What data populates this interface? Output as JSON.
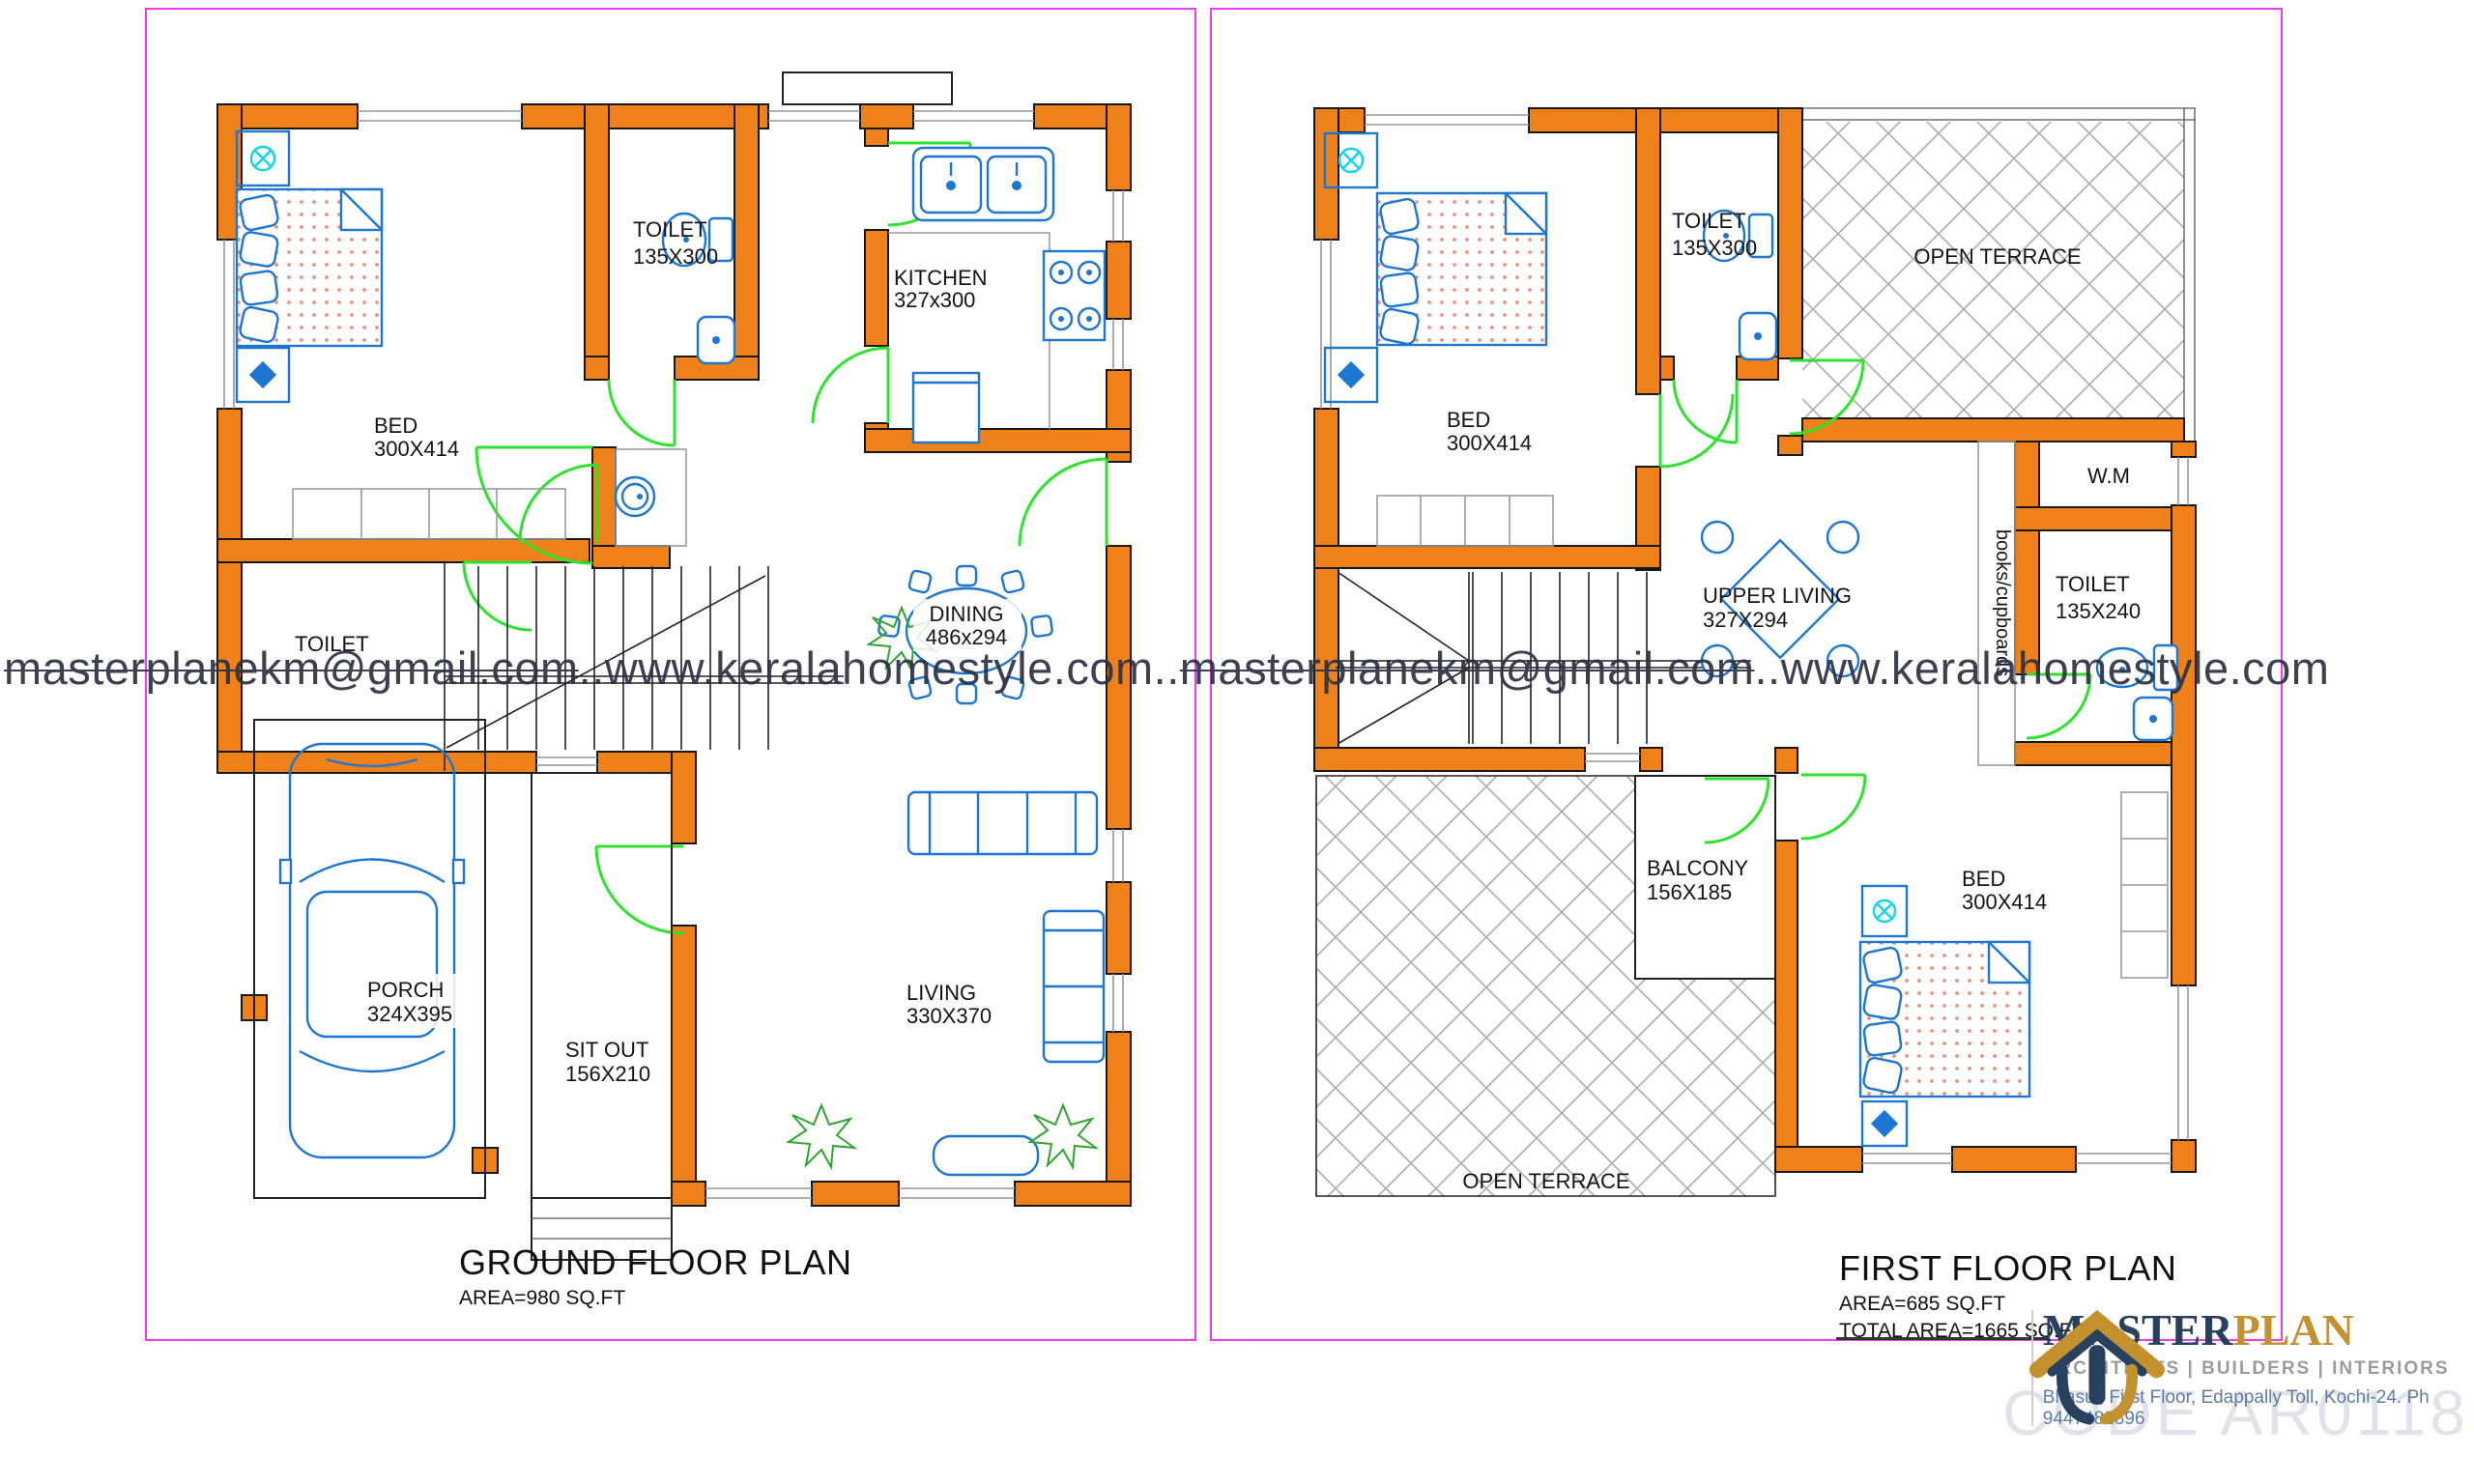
{
  "watermark": {
    "email": "masterplanekm@gmail.com",
    "sep": "..",
    "site": "www.keralahomestyle.com"
  },
  "ground_floor": {
    "title": "GROUND FLOOR PLAN",
    "area_label": "AREA=980 SQ.FT",
    "rooms": {
      "bed": {
        "name": "BED",
        "dims": "300X414"
      },
      "toilet_top": {
        "name": "TOILET",
        "dims": "135X300"
      },
      "kitchen": {
        "name": "KITCHEN",
        "dims": "327x300"
      },
      "dining": {
        "name": "DINING",
        "dims": "486x294"
      },
      "toilet_small": {
        "name": "TOILET"
      },
      "porch": {
        "name": "PORCH",
        "dims": "324X395"
      },
      "sitout": {
        "name": "SIT OUT",
        "dims": "156X210"
      },
      "living": {
        "name": "LIVING",
        "dims": "330X370"
      }
    }
  },
  "first_floor": {
    "title": "FIRST FLOOR PLAN",
    "area_label": "AREA=685 SQ.FT",
    "total_area_label": "TOTAL AREA=1665 SQ.FT",
    "rooms": {
      "bed_top": {
        "name": "BED",
        "dims": "300X414"
      },
      "toilet_top": {
        "name": "TOILET",
        "dims": "135X300"
      },
      "open_terrace_top": {
        "name": "OPEN TERRACE"
      },
      "wm": {
        "name": "W.M"
      },
      "toilet_right": {
        "name": "TOILET",
        "dims": "135X240"
      },
      "upper_living": {
        "name": "UPPER LIVING",
        "dims": "327X294"
      },
      "books": {
        "name": "books/cupboards"
      },
      "balcony": {
        "name": "BALCONY",
        "dims": "156X185"
      },
      "open_terrace_bottom": {
        "name": "OPEN TERRACE"
      },
      "bed_bottom": {
        "name": "BED",
        "dims": "300X414"
      }
    }
  },
  "logo": {
    "brand_primary": "MASTER",
    "brand_secondary": "PLAN",
    "tagline": "ARCHITECTS | BUILDERS | INTERIORS",
    "address": "Bhasul, First Floor, Edappally Toll, Kochi-24. Ph 9447482396",
    "code_watermark": "CODE AR0118"
  },
  "colors": {
    "wall_orange": "#EE8119",
    "panel_border_magenta": "#EE3BEE",
    "door_green": "#2EE22E",
    "fixture_blue": "#1C76D2",
    "hatch_gray": "#ADADAD",
    "watermark_ink": "#2B3144",
    "brand_navy": "#27415F",
    "brand_gold": "#C3922E"
  }
}
